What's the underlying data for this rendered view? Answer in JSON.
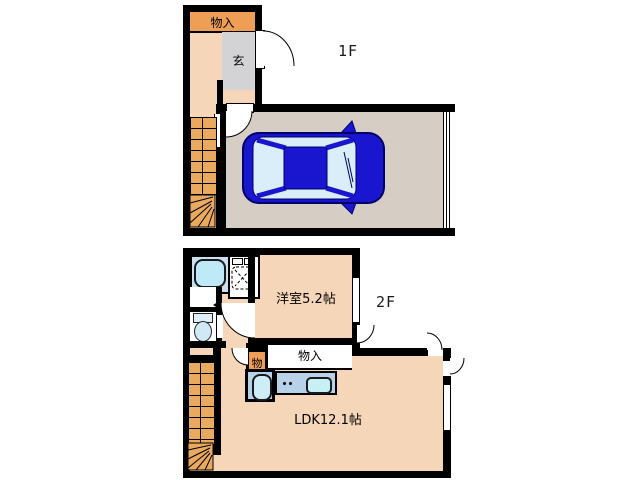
{
  "plan_title": "2-story floor plan",
  "floor1": {
    "label": "1F",
    "storage_label": "物入",
    "entrance_label": "玄",
    "rooms": [
      {
        "name": "storage",
        "label": "物入"
      },
      {
        "name": "entrance",
        "label": "玄"
      },
      {
        "name": "garage",
        "label": "",
        "contains": "car"
      }
    ]
  },
  "floor2": {
    "label": "2F",
    "western_room_label": "洋室5.2帖",
    "ldk_label": "LDK12.1帖",
    "closet_small_label": "物",
    "closet_label": "物入",
    "rooms": [
      {
        "name": "western-room",
        "label": "洋室5.2帖",
        "size_jo": 5.2
      },
      {
        "name": "ldk",
        "label": "LDK12.1帖",
        "size_jo": 12.1
      },
      {
        "name": "bathroom",
        "fixtures": [
          "bathtub",
          "shower-unit",
          "toilet",
          "washstand"
        ]
      },
      {
        "name": "kitchen",
        "fixtures": [
          "sink",
          "stove",
          "counter"
        ]
      }
    ]
  },
  "icons": [
    "car-icon",
    "bathtub-icon",
    "shower-unit-icon",
    "toilet-icon",
    "kitchen-sink-icon",
    "stove-icon",
    "door-arc-icon",
    "window-icon",
    "stairs-icon"
  ],
  "colors": {
    "wall": "#000000",
    "room_floor": "#f5d6b8",
    "stairs": "#e9a95e",
    "storage_orange": "#ef9e55",
    "entrance_gray": "#d3d3d5",
    "garage_floor": "#d6cec5",
    "car_body": "#1a15cf",
    "car_glass": "#d9eef9",
    "fixture_blue": "#cdeef7",
    "counter_blue": "#b7d2e8",
    "bath_panel": "#ccdfee"
  }
}
